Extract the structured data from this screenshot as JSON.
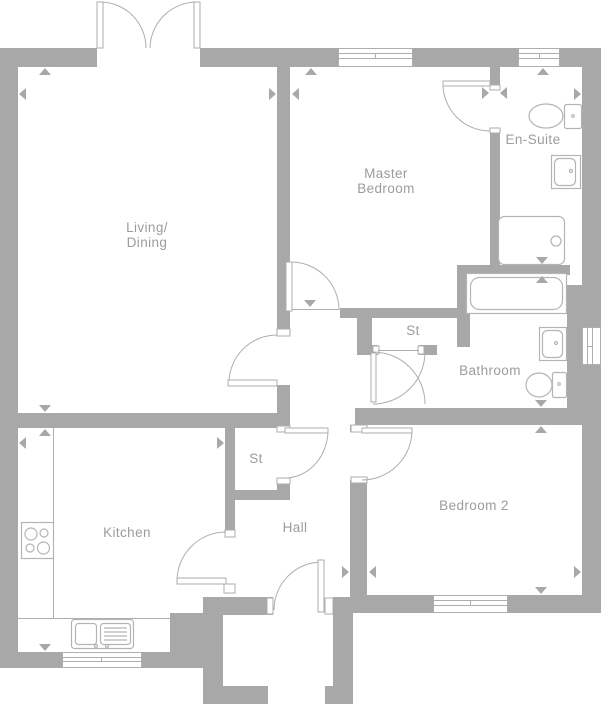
{
  "colors": {
    "wall": "#a8a8a8",
    "line": "#aeaeae",
    "fixture": "#b4b4b4",
    "text": "#9c9c9c",
    "background": "#ffffff"
  },
  "rooms": {
    "living_dining": {
      "line1": "Living/",
      "line2": "Dining"
    },
    "master_bedroom": {
      "line1": "Master",
      "line2": "Bedroom"
    },
    "ensuite": {
      "label": "En-Suite"
    },
    "storage_upper": {
      "label": "St"
    },
    "bathroom": {
      "label": "Bathroom"
    },
    "storage_lower": {
      "label": "St"
    },
    "kitchen": {
      "label": "Kitchen"
    },
    "hall": {
      "label": "Hall"
    },
    "bedroom2": {
      "label": "Bedroom 2"
    }
  },
  "fixtures": [
    "french-doors",
    "entrance-door",
    "hob",
    "kitchen-sink",
    "ensuite-toilet",
    "ensuite-basin",
    "shower-tray",
    "bathtub",
    "bathroom-basin",
    "bathroom-toilet"
  ]
}
